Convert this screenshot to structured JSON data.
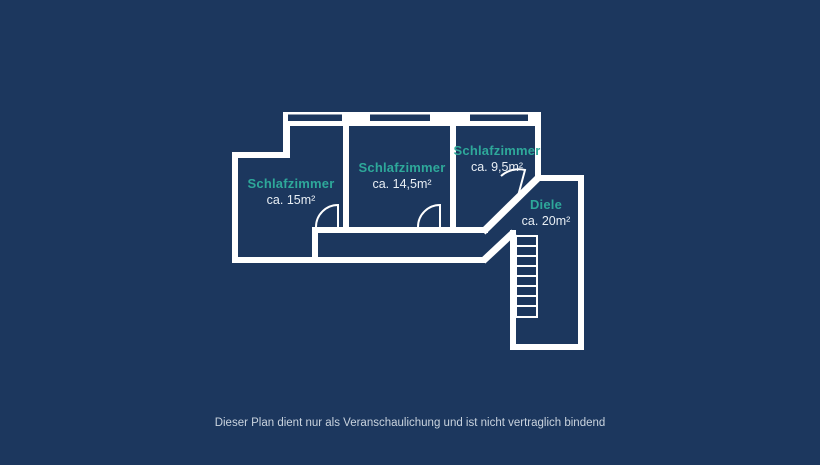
{
  "colors": {
    "background": "#1c375e",
    "wall": "#ffffff",
    "room-name": "#2ea89a",
    "room-area": "#e8eef4",
    "disclaimer": "#c9d3de"
  },
  "rooms": [
    {
      "name": "Schlafzimmer",
      "area": "ca. 15m²"
    },
    {
      "name": "Schlafzimmer",
      "area": "ca. 14,5m²"
    },
    {
      "name": "Schlafzimmer",
      "area": "ca. 9,5m²"
    },
    {
      "name": "Diele",
      "area": "ca. 20m²"
    }
  ],
  "disclaimer": "Dieser Plan dient nur als Veranschaulichung und ist nicht vertraglich bindend"
}
